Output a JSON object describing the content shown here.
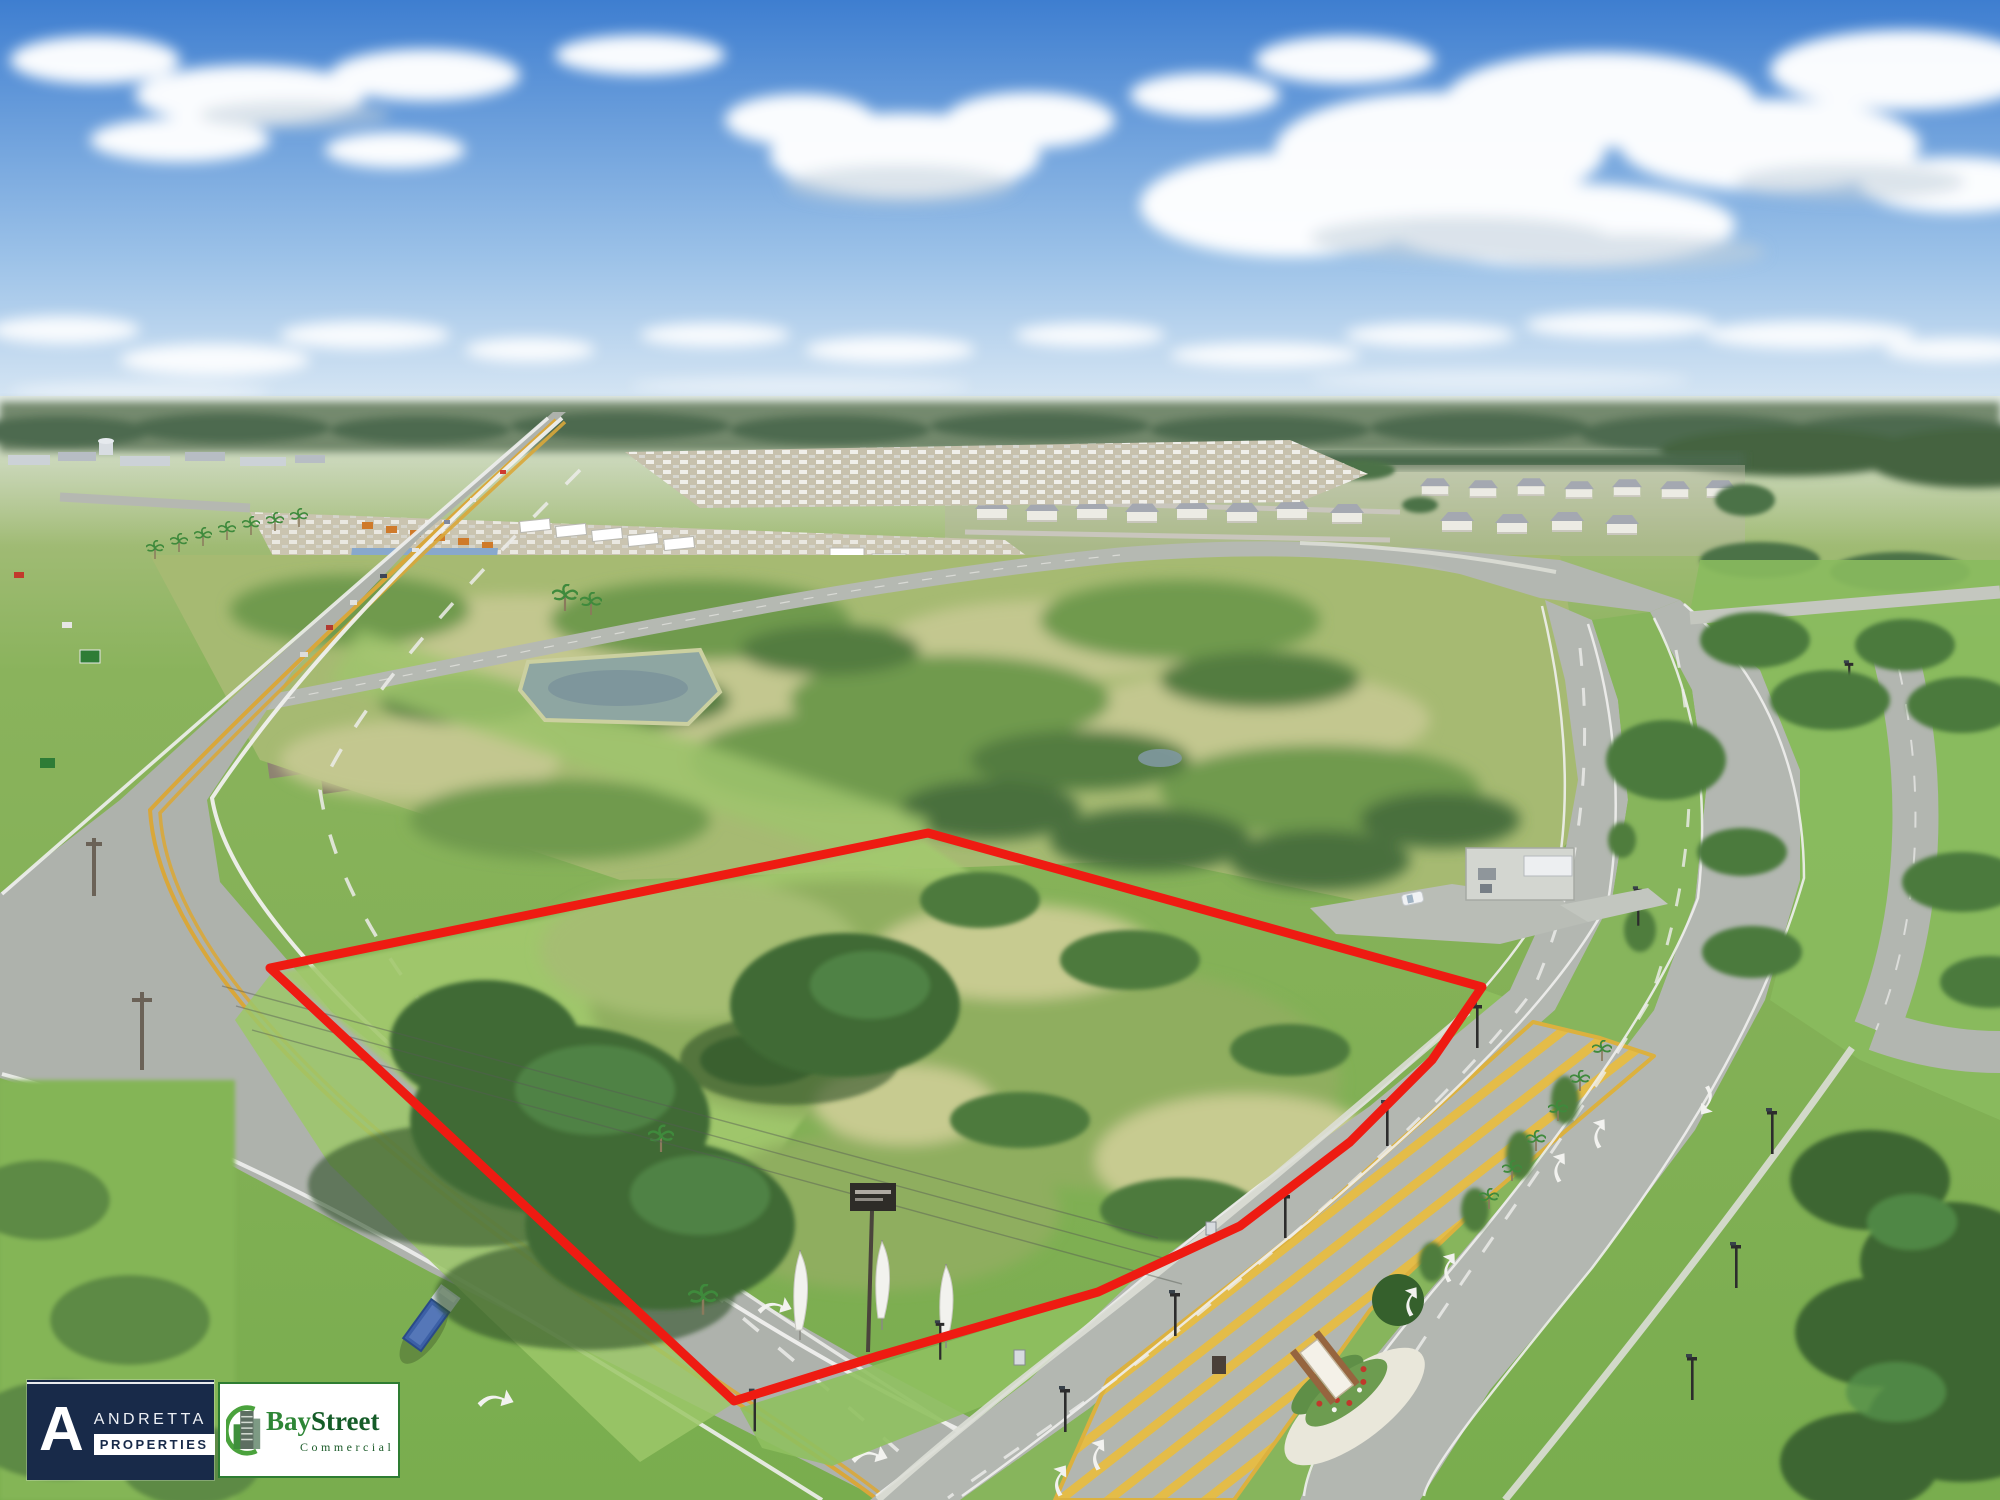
{
  "branding": {
    "andretta": {
      "monogram": "A",
      "line1": "ANDRETTA",
      "line2": "PROPERTIES",
      "colors": {
        "background": "#182a49",
        "monogram_text": "#ffffff",
        "line1_text": "#eef1f6",
        "line2_text": "#182a49",
        "line2_bg": "#ffffff"
      }
    },
    "baystreet": {
      "word1": "Bay",
      "word2": "Street",
      "subtitle": "Commercial",
      "colors": {
        "background": "#ffffff",
        "border": "#2e7d32",
        "word1_text": "#2e8636",
        "word2_text": "#155c28",
        "subtitle_text": "#1c5c2a",
        "icon_green": "#4aa23c",
        "icon_building": "#5d6e62"
      }
    }
  },
  "parcel": {
    "boundary_color": "#ee1b12",
    "boundary_stroke_width": 9,
    "boundary_points": "270,968 928,833 1482,987 1432,1060 1350,1142 1240,1226 1098,1292 878,1356 734,1401"
  },
  "scene": {
    "sky_top": "#3e7ed0",
    "sky_mid": "#9cc2e8",
    "sky_horizon": "#ddeaf5",
    "cloud": "#ffffff",
    "treeline": "#5b7a5e",
    "field_far": "#b9c490",
    "field_mid": "#8ab35c",
    "field_near": "#79ad4e",
    "road": "#aeb2ac",
    "marking_yellow": "#d9a73a",
    "hatch_yellow": "#e4bc48",
    "water": "#8ea6a2",
    "oak_green": "#3f6b34"
  }
}
